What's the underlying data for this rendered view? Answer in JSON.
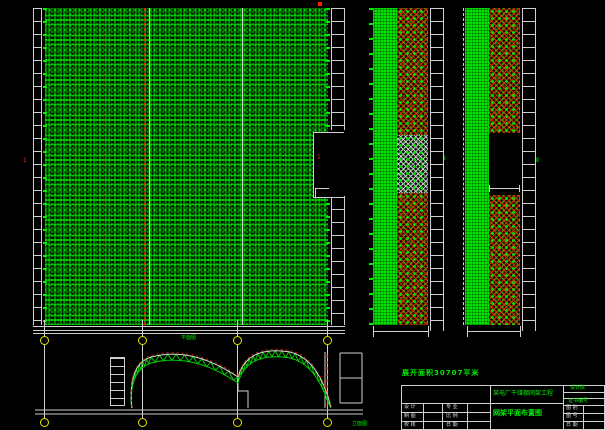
{
  "app": {
    "type": "cad-drawing-canvas",
    "background": "#000000"
  },
  "palette": {
    "green": "#00dd00",
    "red": "#cc2200",
    "white": "#dcdcdc",
    "yellow": "#e6e600"
  },
  "plan": {
    "caption": "平面图",
    "left_axis_mark": "1",
    "door_mark": "1"
  },
  "elevation": {
    "caption": "立面图"
  },
  "panels": {
    "panel1_mark": "Ⅰ",
    "panel2_mark": "Ⅱ"
  },
  "titleblock": {
    "area_label": "展开面积30707平米",
    "project_name": "某电厂干煤棚网架工程",
    "drawing_title": "网架平面布置图",
    "org_label": "设计院",
    "cert_label": "证书编号",
    "left_rows": [
      {
        "a": "设 计",
        "b": "",
        "c": "专 业",
        "d": ""
      },
      {
        "a": "制 图",
        "b": "",
        "c": "比 例",
        "d": ""
      },
      {
        "a": "校 核",
        "b": "",
        "c": "日 期",
        "d": ""
      }
    ],
    "right_rows": [
      {
        "label": "图 别",
        "value": ""
      },
      {
        "label": "图 号",
        "value": ""
      },
      {
        "label": "日 期",
        "value": ""
      }
    ]
  }
}
